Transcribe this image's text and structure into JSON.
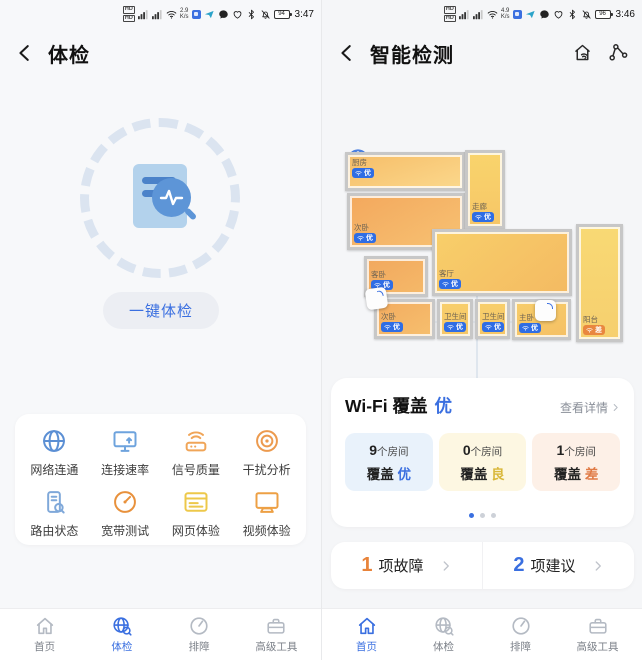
{
  "left_screen": {
    "status_bar": {
      "speed": "2.9",
      "speed_unit": "K/s",
      "battery": "94",
      "time": "3:47",
      "icons": [
        "hd-icon",
        "signal-icon",
        "signal-icon",
        "wifi-icon",
        "app-icon",
        "app-icon",
        "message-icon",
        "heart-icon",
        "bluetooth-icon",
        "bell-muted-icon",
        "battery-icon"
      ]
    },
    "header": {
      "title": "体检",
      "back_icon": "back-arrow-icon"
    },
    "scan": {
      "center_icon": "report-magnifier-icon",
      "button_label": "一键体检"
    },
    "tools": [
      {
        "key": "network-connectivity",
        "label": "网络连通",
        "icon": "globe-icon",
        "color": "#5b8fd4"
      },
      {
        "key": "connection-speed",
        "label": "连接速率",
        "icon": "speed-monitor-icon",
        "color": "#6ea3dd"
      },
      {
        "key": "signal-quality",
        "label": "信号质量",
        "icon": "signal-router-icon",
        "color": "#f0a558"
      },
      {
        "key": "interference-analysis",
        "label": "干扰分析",
        "icon": "interference-icon",
        "color": "#ec9a4e"
      },
      {
        "key": "router-status",
        "label": "路由状态",
        "icon": "router-status-icon",
        "color": "#7fa8d9"
      },
      {
        "key": "broadband-test",
        "label": "宽带测试",
        "icon": "speedtest-icon",
        "color": "#e8913c"
      },
      {
        "key": "web-experience",
        "label": "网页体验",
        "icon": "webpage-icon",
        "color": "#edc84a"
      },
      {
        "key": "video-experience",
        "label": "视频体验",
        "icon": "video-icon",
        "color": "#eda045"
      }
    ],
    "nav": [
      {
        "key": "home",
        "label": "首页",
        "icon": "home-icon",
        "active": false
      },
      {
        "key": "checkup",
        "label": "体检",
        "icon": "health-icon",
        "active": true
      },
      {
        "key": "troubleshoot",
        "label": "排障",
        "icon": "gauge-icon",
        "active": false
      },
      {
        "key": "advanced-tools",
        "label": "高级工具",
        "icon": "toolbox-icon",
        "active": false
      }
    ]
  },
  "right_screen": {
    "status_bar": {
      "speed": "4.9",
      "speed_unit": "K/s",
      "battery": "96",
      "time": "3:46"
    },
    "header": {
      "title": "智能检测",
      "back_icon": "back-arrow-icon",
      "action_icons": [
        "home-wifi-icon",
        "topology-icon"
      ]
    },
    "floorplan": {
      "internet_label": "互联网",
      "router_count": 2,
      "rooms": [
        {
          "name": "厨房",
          "grade": "优",
          "type": "good",
          "x": 23,
          "y": 152,
          "w": 120,
          "h": 39,
          "fill": "linear-gradient(160deg,#f6bd68,#fbd88c)",
          "label_pos": "top"
        },
        {
          "name": "次卧",
          "grade": "优",
          "type": "good",
          "x": 25,
          "y": 193,
          "w": 118,
          "h": 57,
          "fill": "linear-gradient(150deg,#f3a85d,#f7c273)",
          "label_pos": "bottom"
        },
        {
          "name": "走廊",
          "grade": "优",
          "type": "good",
          "x": 143,
          "y": 150,
          "w": 40,
          "h": 79,
          "fill": "linear-gradient(180deg,#f9d46c,#f6c667)",
          "label_pos": "bottom"
        },
        {
          "name": "客厅",
          "grade": "优",
          "type": "good",
          "x": 110,
          "y": 229,
          "w": 140,
          "h": 67,
          "fill": "linear-gradient(140deg,#f8cf6a,#f4ba62)",
          "label_pos": "bottom"
        },
        {
          "name": "客卧",
          "grade": "优",
          "type": "good",
          "x": 42,
          "y": 256,
          "w": 64,
          "h": 41,
          "fill": "linear-gradient(150deg,#f1a85e,#f5b969)",
          "label_pos": "bottom"
        },
        {
          "name": "次卧",
          "grade": "优",
          "type": "good",
          "x": 52,
          "y": 299,
          "w": 61,
          "h": 40,
          "fill": "linear-gradient(150deg,#f3ac60,#f6bf6e)",
          "label_pos": "bottom"
        },
        {
          "name": "卫生间",
          "grade": "优",
          "type": "good",
          "x": 115,
          "y": 299,
          "w": 36,
          "h": 40,
          "fill": "linear-gradient(180deg,#f8cf6b,#f6c666)",
          "label_pos": "bottom"
        },
        {
          "name": "卫生间",
          "grade": "优",
          "type": "good",
          "x": 153,
          "y": 299,
          "w": 35,
          "h": 40,
          "fill": "linear-gradient(180deg,#f8cf6b,#f6c666)",
          "label_pos": "bottom"
        },
        {
          "name": "主卧",
          "grade": "优",
          "type": "good",
          "x": 190,
          "y": 299,
          "w": 59,
          "h": 41,
          "fill": "linear-gradient(160deg,#f7cd6a,#f5c065)",
          "label_pos": "bottom"
        },
        {
          "name": "阳台",
          "grade": "差",
          "type": "bad",
          "x": 254,
          "y": 224,
          "w": 47,
          "h": 118,
          "fill": "linear-gradient(180deg,#f8d974,#f6cf6e)",
          "label_pos": "bottom"
        }
      ]
    },
    "wifi_card": {
      "title": "Wi-Fi 覆盖",
      "grade": "优",
      "grade_color": "#3a6fe0",
      "detail_link": "查看详情",
      "stats": [
        {
          "count": "9",
          "unit": "个房间",
          "label": "覆盖",
          "grade": "优",
          "grade_color": "#3a6fe0",
          "bg": "#e9f2fb"
        },
        {
          "count": "0",
          "unit": "个房间",
          "label": "覆盖",
          "grade": "良",
          "grade_color": "#d9b83a",
          "bg": "#fdf7e2"
        },
        {
          "count": "1",
          "unit": "个房间",
          "label": "覆盖",
          "grade": "差",
          "grade_color": "#e07a45",
          "bg": "#fdf0e7"
        }
      ],
      "dots_total": 3,
      "dots_active_index": 0
    },
    "issues_card": [
      {
        "count": "1",
        "label": "项故障",
        "count_color": "#e8833a"
      },
      {
        "count": "2",
        "label": "项建议",
        "count_color": "#3a6fe0"
      }
    ],
    "nav": [
      {
        "key": "home",
        "label": "首页",
        "icon": "home-icon",
        "active": true
      },
      {
        "key": "checkup",
        "label": "体检",
        "icon": "health-icon",
        "active": false
      },
      {
        "key": "troubleshoot",
        "label": "排障",
        "icon": "gauge-icon",
        "active": false
      },
      {
        "key": "advanced-tools",
        "label": "高级工具",
        "icon": "toolbox-icon",
        "active": false
      }
    ]
  }
}
